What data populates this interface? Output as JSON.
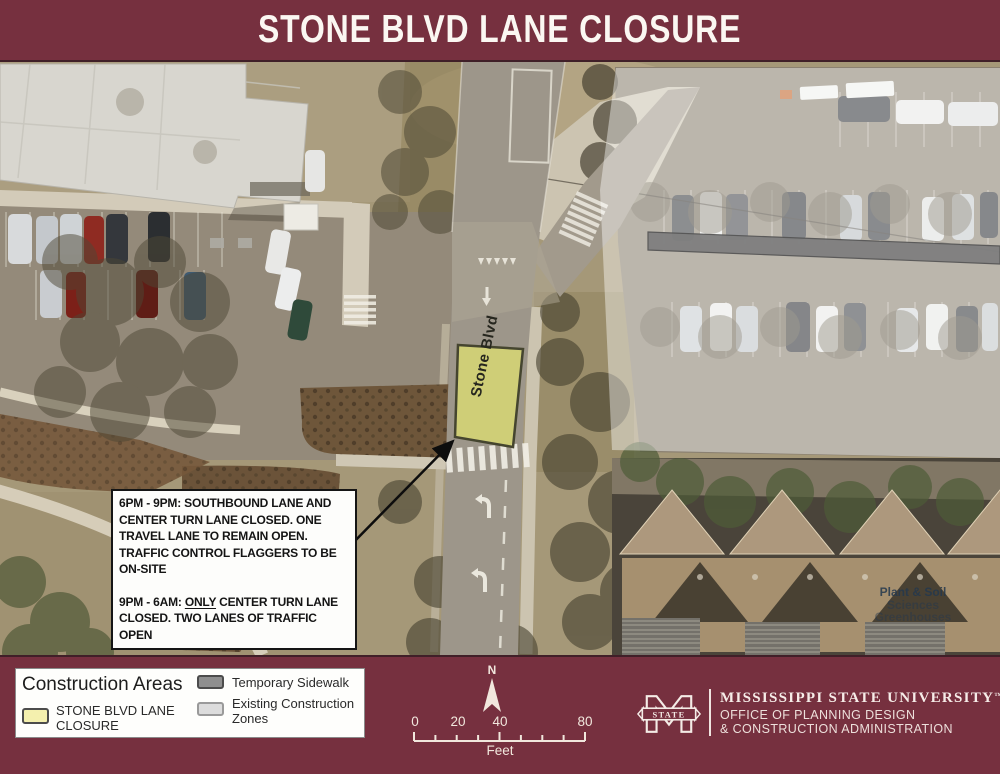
{
  "title": "STONE BLVD LANE CLOSURE",
  "map": {
    "road_label": "Stone Blvd",
    "area_label": {
      "line1": "Plant & Soil",
      "line2": "Sciences",
      "line3": "Greenhouses"
    },
    "callout": {
      "para1": "6PM - 9PM: SOUTHBOUND LANE AND\nCENTER TURN LANE CLOSED. ONE\nTRAVEL LANE TO REMAIN OPEN.\nTRAFFIC CONTROL FLAGGERS TO BE\nON-SITE",
      "para2_prefix": "9PM - 6AM: ",
      "para2_underlined": "ONLY",
      "para2_suffix": " CENTER TURN LANE\nCLOSED. TWO LANES OF TRAFFIC OPEN"
    }
  },
  "legend": {
    "title": "Construction Areas",
    "items": [
      {
        "label": "STONE BLVD LANE\nCLOSURE",
        "color": "#f4f0ae"
      },
      {
        "label": "Temporary Sidewalk",
        "color": "#8f8f8f"
      },
      {
        "label": "Existing Construction\nZones",
        "color": "#dcdcdc"
      }
    ]
  },
  "compass": {
    "north_label": "N"
  },
  "scalebar": {
    "labels": [
      "0",
      "20",
      "40",
      "80"
    ],
    "unit": "Feet"
  },
  "branding": {
    "university": "MISSISSIPPI STATE UNIVERSITY",
    "trademark": "™",
    "office_line1": "OFFICE OF PLANNING DESIGN",
    "office_line2": "& CONSTRUCTION ADMINISTRATION",
    "logo_text": "STATE"
  },
  "colors": {
    "maroon": "#76303f",
    "closure_zone_fill": "#dcdc72",
    "temporary_sidewalk": "#8f8f8f",
    "existing_construction_zone": "#dcdcdc"
  }
}
